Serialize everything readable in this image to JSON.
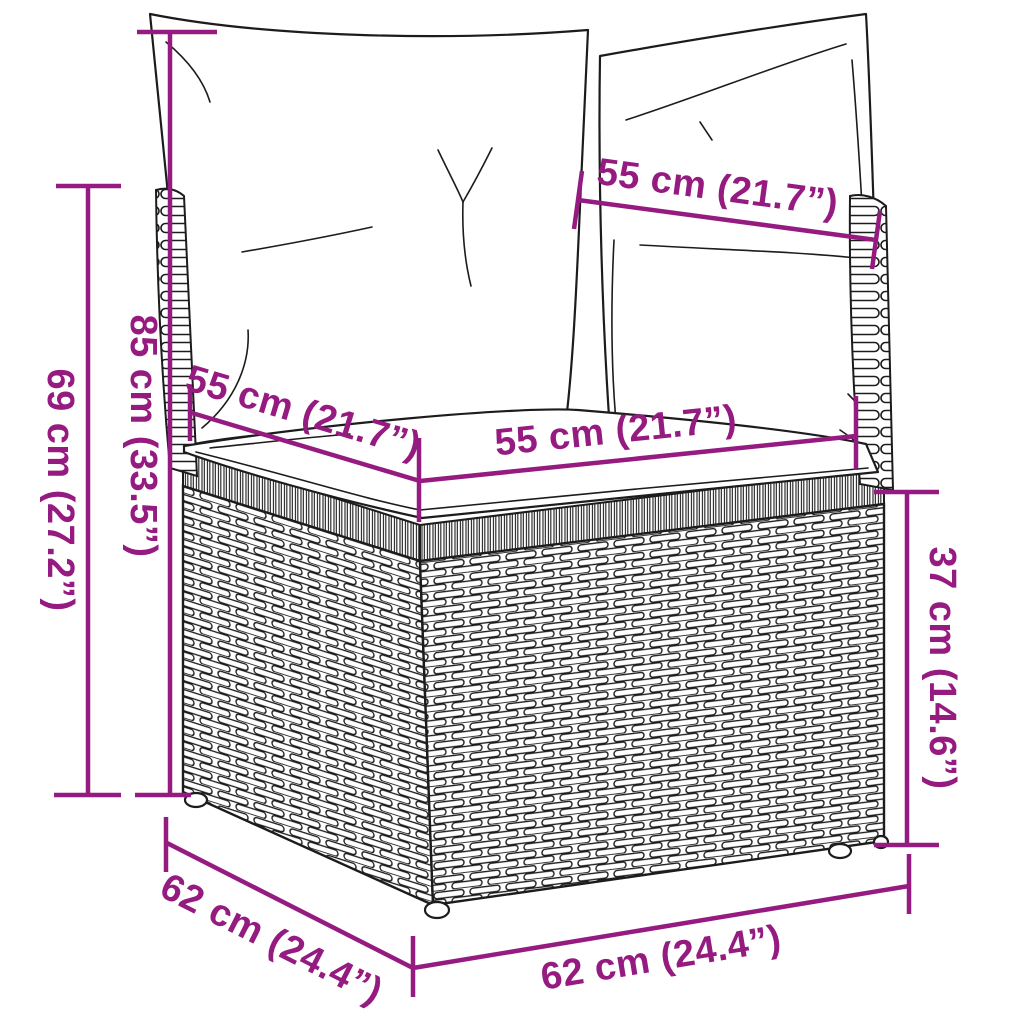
{
  "meta": {
    "subject": "line-art dimension diagram of a poly rattan corner sofa section with back cushions and seat cushion"
  },
  "style": {
    "accent_color": "#951b81",
    "line_color": "#1c1c1c",
    "background": "#ffffff"
  },
  "dimensions": {
    "back_width": "55 cm (21.7”)",
    "seat_depth": "55 cm (21.7”)",
    "seat_width": "55 cm (21.7”)",
    "total_height": "85 cm (33.5”)",
    "armrest_height": "69 cm (27.2”)",
    "base_height": "37 cm (14.6”)",
    "base_depth": "62 cm (24.4”)",
    "base_width": "62 cm (24.4”)"
  }
}
